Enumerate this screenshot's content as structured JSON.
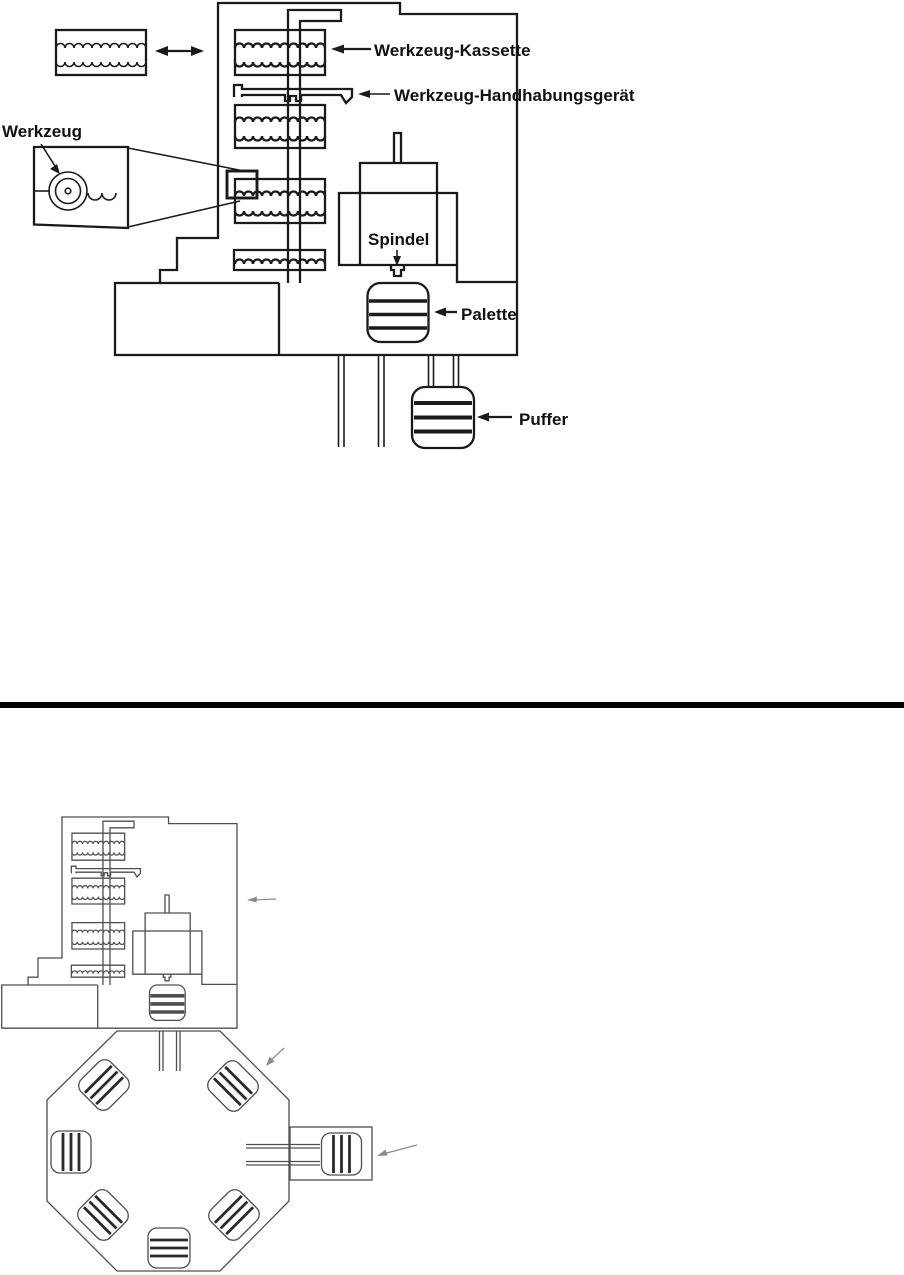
{
  "figure": {
    "background": "#ffffff",
    "divider_color": "#000000",
    "top_diagram": {
      "line_color": "#1a1a1a",
      "labels": {
        "tool_cassette": "Werkzeug-Kassette",
        "tool_handling_device": "Werkzeug-Handhabungsgerät",
        "tool": "Werkzeug",
        "spindle": "Spindel",
        "pallet": "Palette",
        "buffer": "Puffer"
      }
    },
    "bottom_diagram": {
      "line_color": "#4f4f4f",
      "arrow_color": "#8a8a8a",
      "labels": {}
    }
  }
}
